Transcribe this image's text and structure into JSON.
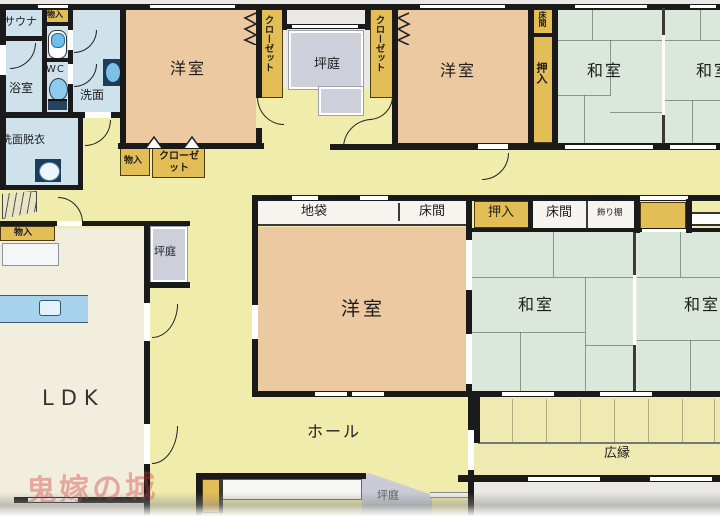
{
  "plan_title": "間取り図",
  "rooms": {
    "sauna": {
      "label": "サウナ"
    },
    "bathroom": {
      "label": "浴室"
    },
    "wc": {
      "label": "WC"
    },
    "washroom": {
      "label": "洗面"
    },
    "washroom_dressing": {
      "label": "洗面脱衣"
    },
    "storage_1": {
      "label": "物入"
    },
    "western_1": {
      "label": "洋室"
    },
    "closet_1": {
      "label": "クローゼット"
    },
    "garden_top": {
      "label": "坪庭"
    },
    "closet_2": {
      "label": "クローゼット"
    },
    "western_2": {
      "label": "洋室"
    },
    "tokonoma_1": {
      "label": "床間"
    },
    "oshiire_1": {
      "label": "押入"
    },
    "japanese_1": {
      "label": "和室"
    },
    "japanese_2": {
      "label": "和室"
    },
    "storage_2": {
      "label": "物入"
    },
    "closet_3": {
      "label": "クローゼット"
    },
    "storage_3": {
      "label": "物入"
    },
    "garden_mid": {
      "label": "坪庭"
    },
    "jibukuro": {
      "label": "地袋"
    },
    "tokonoma_2": {
      "label": "床間"
    },
    "oshiire_2": {
      "label": "押入"
    },
    "tokonoma_3": {
      "label": "床間"
    },
    "kazaridana": {
      "label": "飾り棚"
    },
    "western_3": {
      "label": "洋室"
    },
    "japanese_3": {
      "label": "和室"
    },
    "japanese_4": {
      "label": "和室"
    },
    "ldk": {
      "label": "LDK"
    },
    "hall": {
      "label": "ホール"
    },
    "veranda": {
      "label": "広縁"
    },
    "garden_bottom": {
      "label": "坪庭"
    }
  },
  "watermark": {
    "text": "鬼嫁の城"
  },
  "colors": {
    "wall": "#1a1a1a",
    "hallway": "#efecac",
    "ldk": "#f2eedd",
    "western_room": "#ecc9a1",
    "japanese_room": "#dbe7da",
    "wet_area": "#cfe2ec",
    "storage": "#e3bd55",
    "garden": "#cdd0db",
    "kitchen_counter": "#a6d2ee",
    "veranda": "#efeab2",
    "watermark": "#cd3737"
  }
}
